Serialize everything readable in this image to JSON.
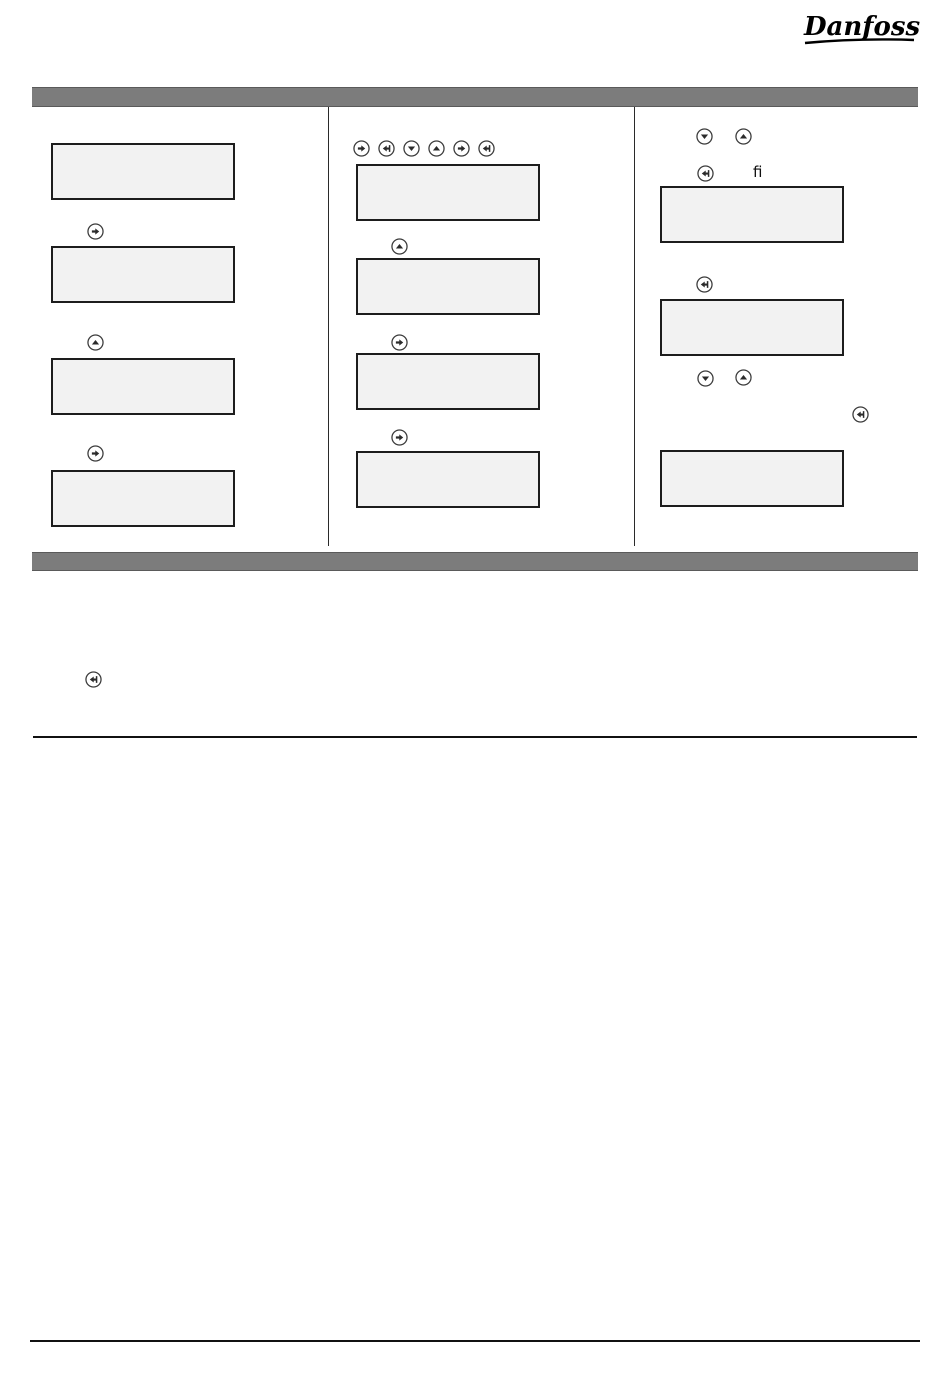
{
  "brand": {
    "logo_text": "Danfoss"
  },
  "section_bars": {
    "top": {
      "label": ""
    },
    "bottom": {
      "label": ""
    }
  },
  "right_column": {
    "inline_text": "fi"
  },
  "icons": {
    "right_arrow": "➜",
    "enter": "⏎",
    "down_arrow": "▼",
    "up_arrow": "▲"
  },
  "colors": {
    "section_bar": "#7c7c7c",
    "section_bar_edge": "#5a5a5a",
    "display_fill": "#f2f2f2",
    "display_border": "#1d1d1d",
    "icon_color": "#2b2b2b",
    "divider": "#2a2a2a",
    "rule": "#111111",
    "page_bg": "#ffffff"
  }
}
